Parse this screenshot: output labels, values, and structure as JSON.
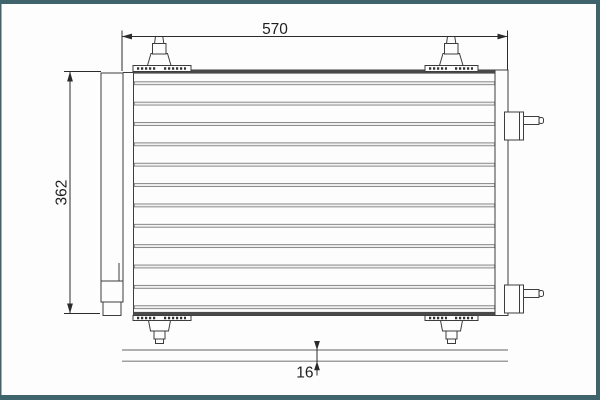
{
  "labels": {
    "width": "570",
    "height": "362",
    "depth": "16"
  },
  "colors": {
    "background": "#fcfdfc",
    "frame": "#3f646b",
    "line": "#3d3d3d",
    "tube_line": "#7e7e7e",
    "dimension": "#2b2b2b",
    "ground_line": "#828282"
  },
  "figure": {
    "tube_count": 12
  }
}
